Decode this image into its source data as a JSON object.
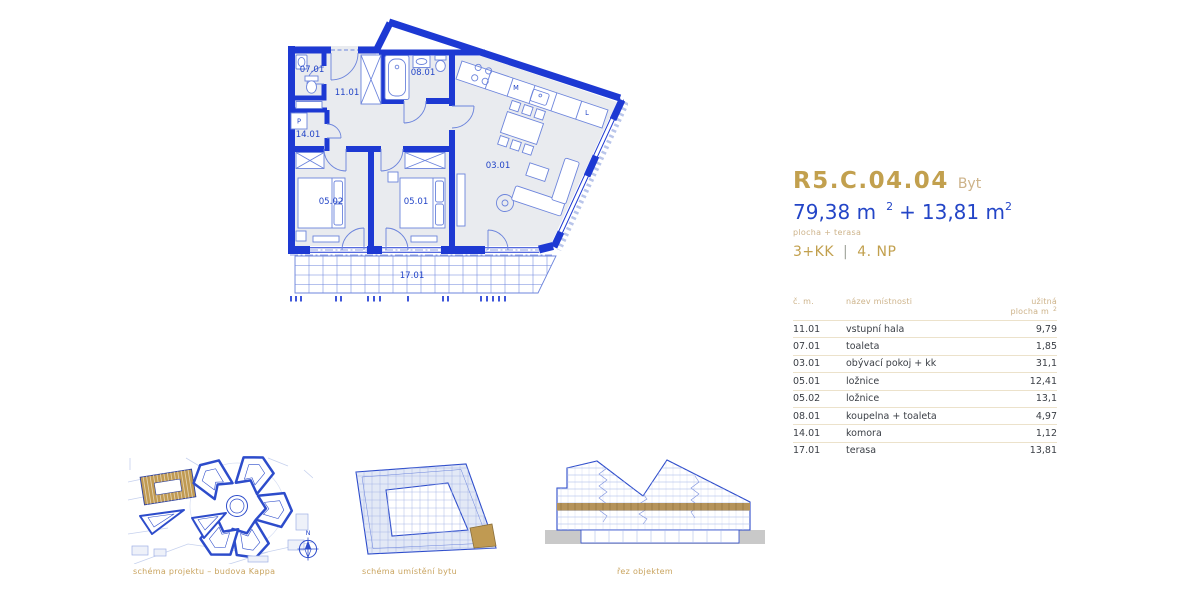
{
  "unit": {
    "code": "R5.C.04.04",
    "type_label": "Byt",
    "area_main": "79,38 m",
    "area_main_sup": "2",
    "plus_sign": "+",
    "area_terrace": "13,81 m",
    "area_terrace_sup": "2",
    "area_caption": "plocha + terasa",
    "disposition": "3+KK",
    "divider": "|",
    "floor": "4. NP"
  },
  "rooms_table": {
    "col_number": "č. m.",
    "col_name": "název místnosti",
    "col_area_line1": "užitná",
    "col_area_line2": "plocha m",
    "col_area_sup": "2",
    "rows": [
      {
        "num": "11.01",
        "name": "vstupní hala",
        "area": "9,79"
      },
      {
        "num": "07.01",
        "name": "toaleta",
        "area": "1,85"
      },
      {
        "num": "03.01",
        "name": "obývací pokoj + kk",
        "area": "31,1"
      },
      {
        "num": "05.01",
        "name": "ložnice",
        "area": "12,41"
      },
      {
        "num": "05.02",
        "name": "ložnice",
        "area": "13,1"
      },
      {
        "num": "08.01",
        "name": "koupelna + toaleta",
        "area": "4,97"
      },
      {
        "num": "14.01",
        "name": "komora",
        "area": "1,12"
      },
      {
        "num": "17.01",
        "name": "terasa",
        "area": "13,81"
      }
    ]
  },
  "floor_plan": {
    "labels": {
      "toilet": "07.01",
      "entry_hall": "11.01",
      "bathroom": "08.01",
      "storage": "14.01",
      "living_kitchen": "03.01",
      "bedroom_1": "05.01",
      "bedroom_2": "05.02",
      "terrace": "17.01",
      "washer": "P",
      "dishwasher": "M",
      "fridge": "L"
    }
  },
  "thumbnails": {
    "site_plan_caption": "schéma projektu – budova Kappa",
    "unit_location_caption": "schéma umístění bytu",
    "section_caption": "řez objektem",
    "compass_label": "N"
  },
  "colors": {
    "wall_blue": "#1d39d3",
    "line_blue": "#6c84dc",
    "pale_blue": "#b9c5ea",
    "text_blue": "#2345c7",
    "room_fill": "#e9ebef",
    "gold": "#c2a04e",
    "gold_soft": "#cdb38a",
    "caption_gold": "#c9a45f",
    "gold_fill": "#c09a52",
    "table_text": "#3a3e45",
    "table_line": "#ece2cb",
    "pipe_gray": "#a3a89f",
    "ground_gray": "#c9c9c9",
    "thumb_blue": "#2d4ccb"
  }
}
